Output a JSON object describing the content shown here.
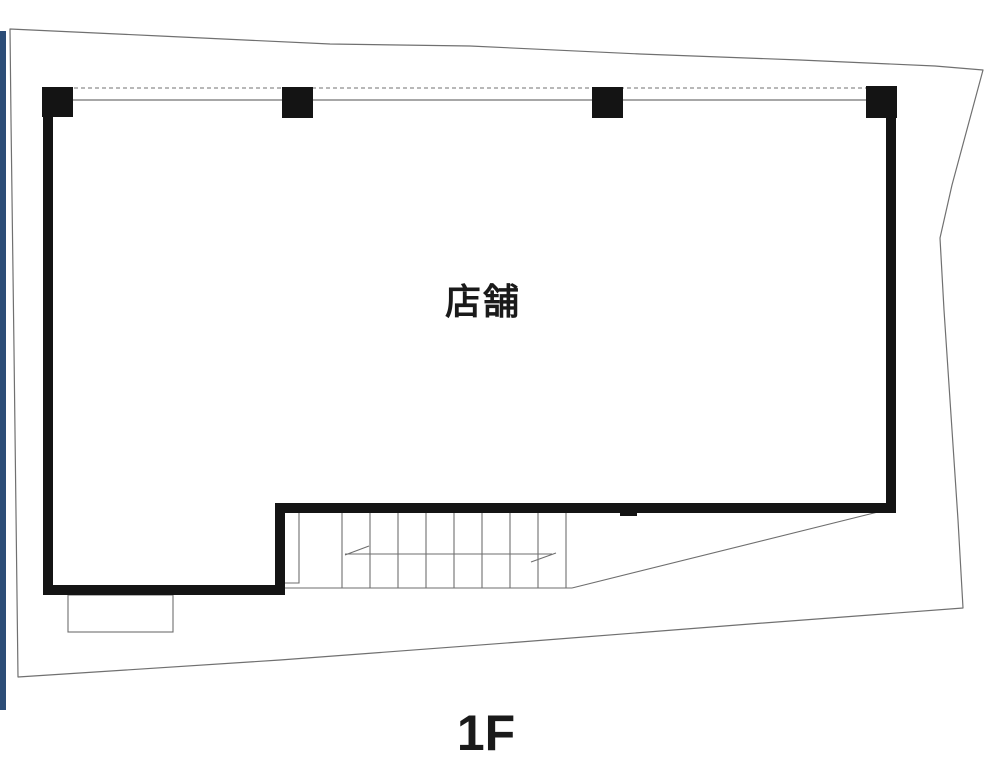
{
  "page": {
    "background": "#ffffff"
  },
  "floor_plan": {
    "room_label": "店舗",
    "floor_label": "1F",
    "colors": {
      "wall": "#141414",
      "thin_line": "#6e6e6e",
      "boundary_line": "#707070",
      "dotted_line": "#a0a0a0",
      "accent_bar": "#2c4d77",
      "label_color": "#1a1a1a",
      "bg": "#ffffff"
    }
  }
}
